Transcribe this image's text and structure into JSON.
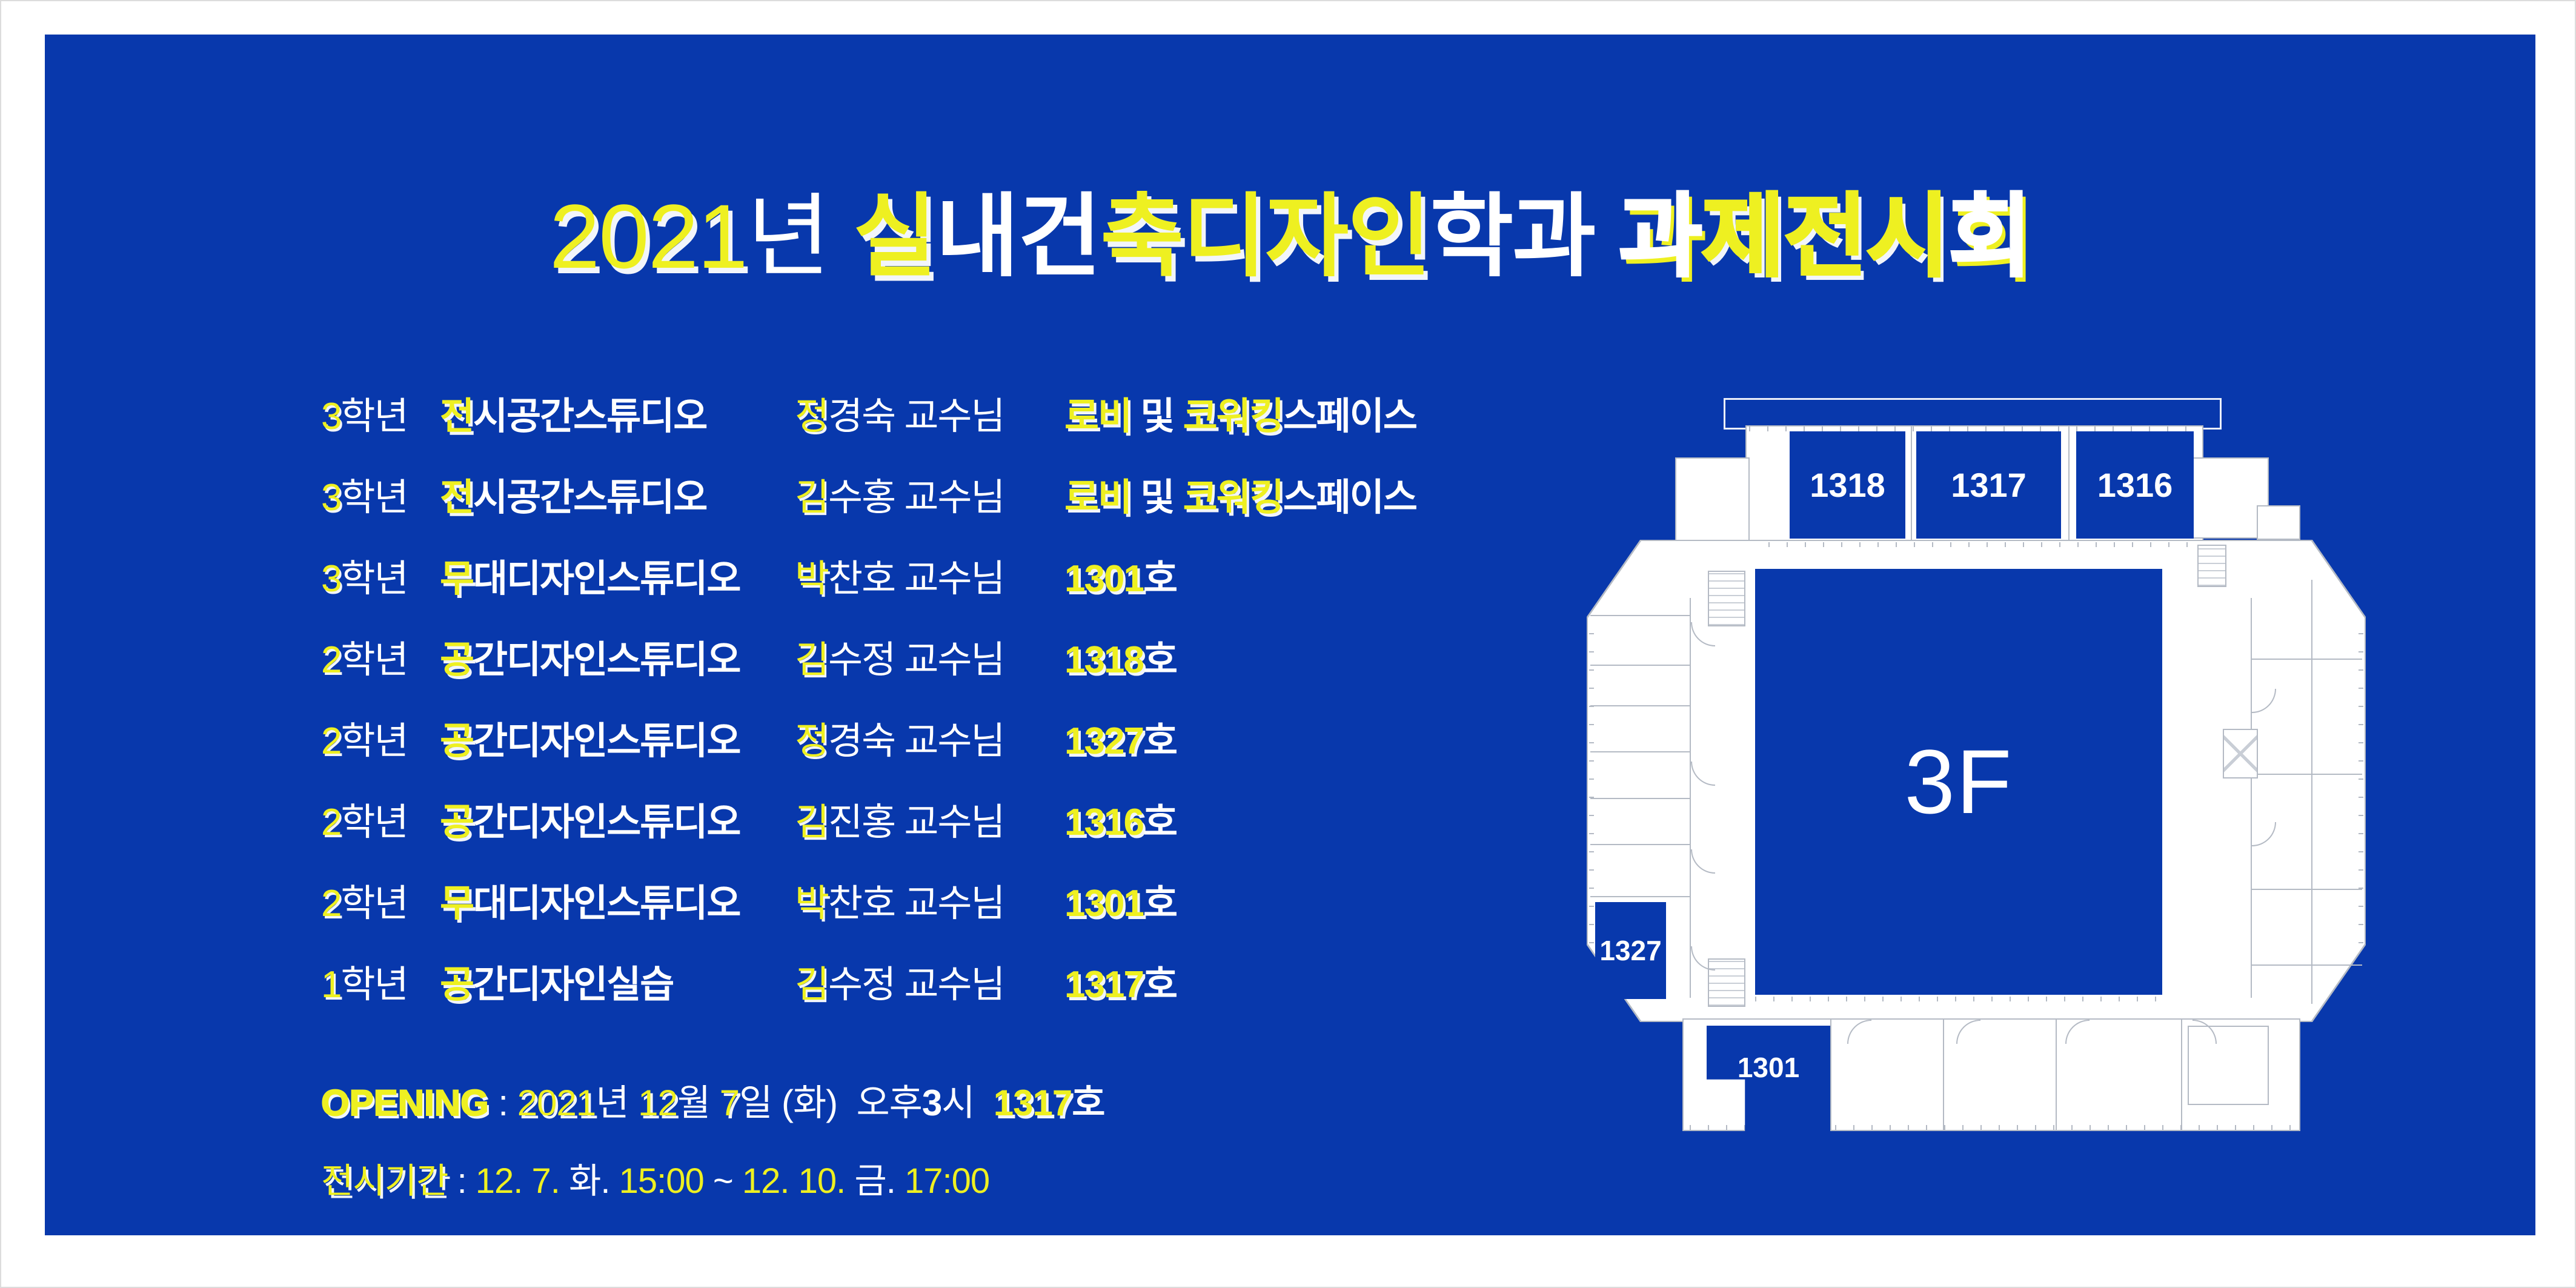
{
  "colors": {
    "panel_blue": "#0838ac",
    "accent_yellow": "#eef021",
    "text_white": "#ffffff",
    "plan_line_gray": "#b4bac4"
  },
  "title": {
    "text": "2021년 실내건축디자인학과 과제전시회",
    "chars": [
      {
        "t": "2",
        "c": "y",
        "w": "t"
      },
      {
        "t": "0",
        "c": "y",
        "w": "t"
      },
      {
        "t": "2",
        "c": "y",
        "w": "t"
      },
      {
        "t": "1",
        "c": "y",
        "w": "t"
      },
      {
        "t": "년",
        "c": "w",
        "w": "t"
      },
      {
        "t": " ",
        "c": "w",
        "w": "t"
      },
      {
        "t": "실",
        "c": "y",
        "w": "m"
      },
      {
        "t": "내",
        "c": "w",
        "w": "m"
      },
      {
        "t": "건",
        "c": "w",
        "w": "m"
      },
      {
        "t": "축",
        "c": "y",
        "w": "m"
      },
      {
        "t": "디",
        "c": "y",
        "w": "m"
      },
      {
        "t": "자",
        "c": "y",
        "w": "m"
      },
      {
        "t": "인",
        "c": "y",
        "w": "m"
      },
      {
        "t": "학",
        "c": "w",
        "w": "m"
      },
      {
        "t": "과",
        "c": "w",
        "w": "m"
      },
      {
        "t": " ",
        "c": "w",
        "w": "m"
      },
      {
        "t": "과",
        "c": "w",
        "w": "h"
      },
      {
        "t": "제",
        "c": "y",
        "w": "h"
      },
      {
        "t": "전",
        "c": "y",
        "w": "h"
      },
      {
        "t": "시",
        "c": "y",
        "w": "h"
      },
      {
        "t": "회",
        "c": "w",
        "w": "h"
      }
    ]
  },
  "schedule": {
    "rows": [
      {
        "grade": {
          "num": "3",
          "suffix": "학년"
        },
        "studio": {
          "first": "전",
          "rest": "시공간스튜디오"
        },
        "professor": {
          "first": "정",
          "rest": "경숙 교수님"
        },
        "location": [
          {
            "t": "로비",
            "c": "y"
          },
          {
            "t": " 및 ",
            "c": "w"
          },
          {
            "t": "코워킹",
            "c": "y"
          },
          {
            "t": "스페이스",
            "c": "w"
          }
        ]
      },
      {
        "grade": {
          "num": "3",
          "suffix": "학년"
        },
        "studio": {
          "first": "전",
          "rest": "시공간스튜디오"
        },
        "professor": {
          "first": "김",
          "rest": "수홍 교수님"
        },
        "location": [
          {
            "t": "로비",
            "c": "y"
          },
          {
            "t": " 및 ",
            "c": "w"
          },
          {
            "t": "코워킹",
            "c": "y"
          },
          {
            "t": "스페이스",
            "c": "w"
          }
        ]
      },
      {
        "grade": {
          "num": "3",
          "suffix": "학년"
        },
        "studio": {
          "first": "무",
          "rest": "대디자인스튜디오"
        },
        "professor": {
          "first": "박",
          "rest": "찬호 교수님"
        },
        "location": [
          {
            "t": "1301",
            "c": "y"
          },
          {
            "t": "호",
            "c": "w"
          }
        ]
      },
      {
        "grade": {
          "num": "2",
          "suffix": "학년"
        },
        "studio": {
          "first": "공",
          "rest": "간디자인스튜디오"
        },
        "professor": {
          "first": "김",
          "rest": "수정 교수님"
        },
        "location": [
          {
            "t": "1318",
            "c": "y"
          },
          {
            "t": "호",
            "c": "w"
          }
        ]
      },
      {
        "grade": {
          "num": "2",
          "suffix": "학년"
        },
        "studio": {
          "first": "공",
          "rest": "간디자인스튜디오"
        },
        "professor": {
          "first": "정",
          "rest": "경숙 교수님"
        },
        "location": [
          {
            "t": "1327",
            "c": "y"
          },
          {
            "t": "호",
            "c": "w"
          }
        ]
      },
      {
        "grade": {
          "num": "2",
          "suffix": "학년"
        },
        "studio": {
          "first": "공",
          "rest": "간디자인스튜디오"
        },
        "professor": {
          "first": "김",
          "rest": "진홍 교수님"
        },
        "location": [
          {
            "t": "1316",
            "c": "y"
          },
          {
            "t": "호",
            "c": "w"
          }
        ]
      },
      {
        "grade": {
          "num": "2",
          "suffix": "학년"
        },
        "studio": {
          "first": "무",
          "rest": "대디자인스튜디오"
        },
        "professor": {
          "first": "박",
          "rest": "찬호 교수님"
        },
        "location": [
          {
            "t": "1301",
            "c": "y"
          },
          {
            "t": "호",
            "c": "w"
          }
        ]
      },
      {
        "grade": {
          "num": "1",
          "suffix": "학년"
        },
        "studio": {
          "first": "공",
          "rest": "간디자인실습"
        },
        "professor": {
          "first": "김",
          "rest": "수정 교수님"
        },
        "location": [
          {
            "t": "1317",
            "c": "y"
          },
          {
            "t": "호",
            "c": "w"
          }
        ]
      }
    ]
  },
  "opening": {
    "line1": [
      {
        "t": "OPENING",
        "c": "y",
        "b": true,
        "sh": true,
        "label": true
      },
      {
        "t": " : ",
        "c": "w"
      },
      {
        "t": "2021",
        "c": "y",
        "sh": true
      },
      {
        "t": "년 ",
        "c": "w"
      },
      {
        "t": "12",
        "c": "y",
        "sh": true
      },
      {
        "t": "월 ",
        "c": "w"
      },
      {
        "t": "7",
        "c": "y",
        "sh": true
      },
      {
        "t": "일 (화)",
        "c": "w"
      },
      {
        "t": "  오후",
        "c": "w"
      },
      {
        "t": "3",
        "c": "w",
        "b": true
      },
      {
        "t": "시  ",
        "c": "w"
      },
      {
        "t": "1317",
        "c": "y",
        "b": true,
        "sh": true
      },
      {
        "t": "호",
        "c": "w",
        "b": true
      }
    ],
    "line2": [
      {
        "t": "전시기간",
        "c": "y",
        "sh": true
      },
      {
        "t": " : ",
        "c": "w"
      },
      {
        "t": "12. 7. ",
        "c": "y"
      },
      {
        "t": "화. ",
        "c": "w"
      },
      {
        "t": "15:00 ",
        "c": "y"
      },
      {
        "t": "~ ",
        "c": "w"
      },
      {
        "t": "12. 10. ",
        "c": "y"
      },
      {
        "t": "금. ",
        "c": "w"
      },
      {
        "t": "17:00",
        "c": "y"
      }
    ]
  },
  "floor_plan": {
    "floor_label": "3F",
    "rooms": [
      {
        "label": "1318"
      },
      {
        "label": "1317"
      },
      {
        "label": "1316"
      },
      {
        "label": "1327"
      },
      {
        "label": "1301"
      }
    ]
  }
}
